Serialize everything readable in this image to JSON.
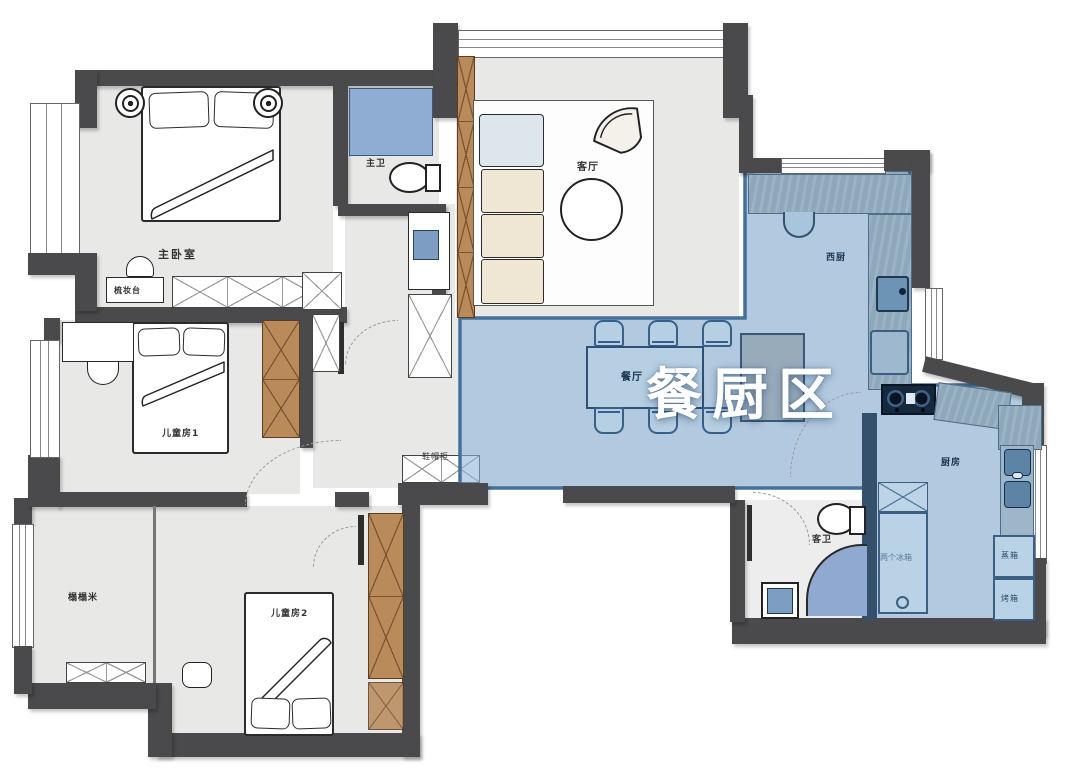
{
  "floorplan": {
    "highlight": {
      "label": "餐厨区"
    },
    "rooms": {
      "master_bedroom": "主卧室",
      "master_bath": "主卫",
      "living_room": "客厅",
      "dining_room": "餐厅",
      "west_kitchen": "西厨",
      "kitchen": "厨房",
      "guest_bath": "客卫",
      "kids_room_1": "儿童房1",
      "kids_room_2": "儿童房2",
      "tatami": "榻榻米"
    },
    "fixtures": {
      "dressing_table": "梳妆台",
      "shoe_cabinet": "鞋帽柜",
      "two_fridges": "两个冰箱",
      "steam_oven": "蒸箱",
      "oven": "烤箱"
    },
    "colors": {
      "hl_fill": "#8cb4d9",
      "hl_border": "#46709c",
      "wall": "#4a4a4c",
      "floor": "#e8e8e7",
      "wood": "#b98a5a",
      "counter": "#8da7bb",
      "fixture": "#bad2e6",
      "fixture_border": "#3a5f82",
      "shower": "#8fadd2"
    }
  }
}
